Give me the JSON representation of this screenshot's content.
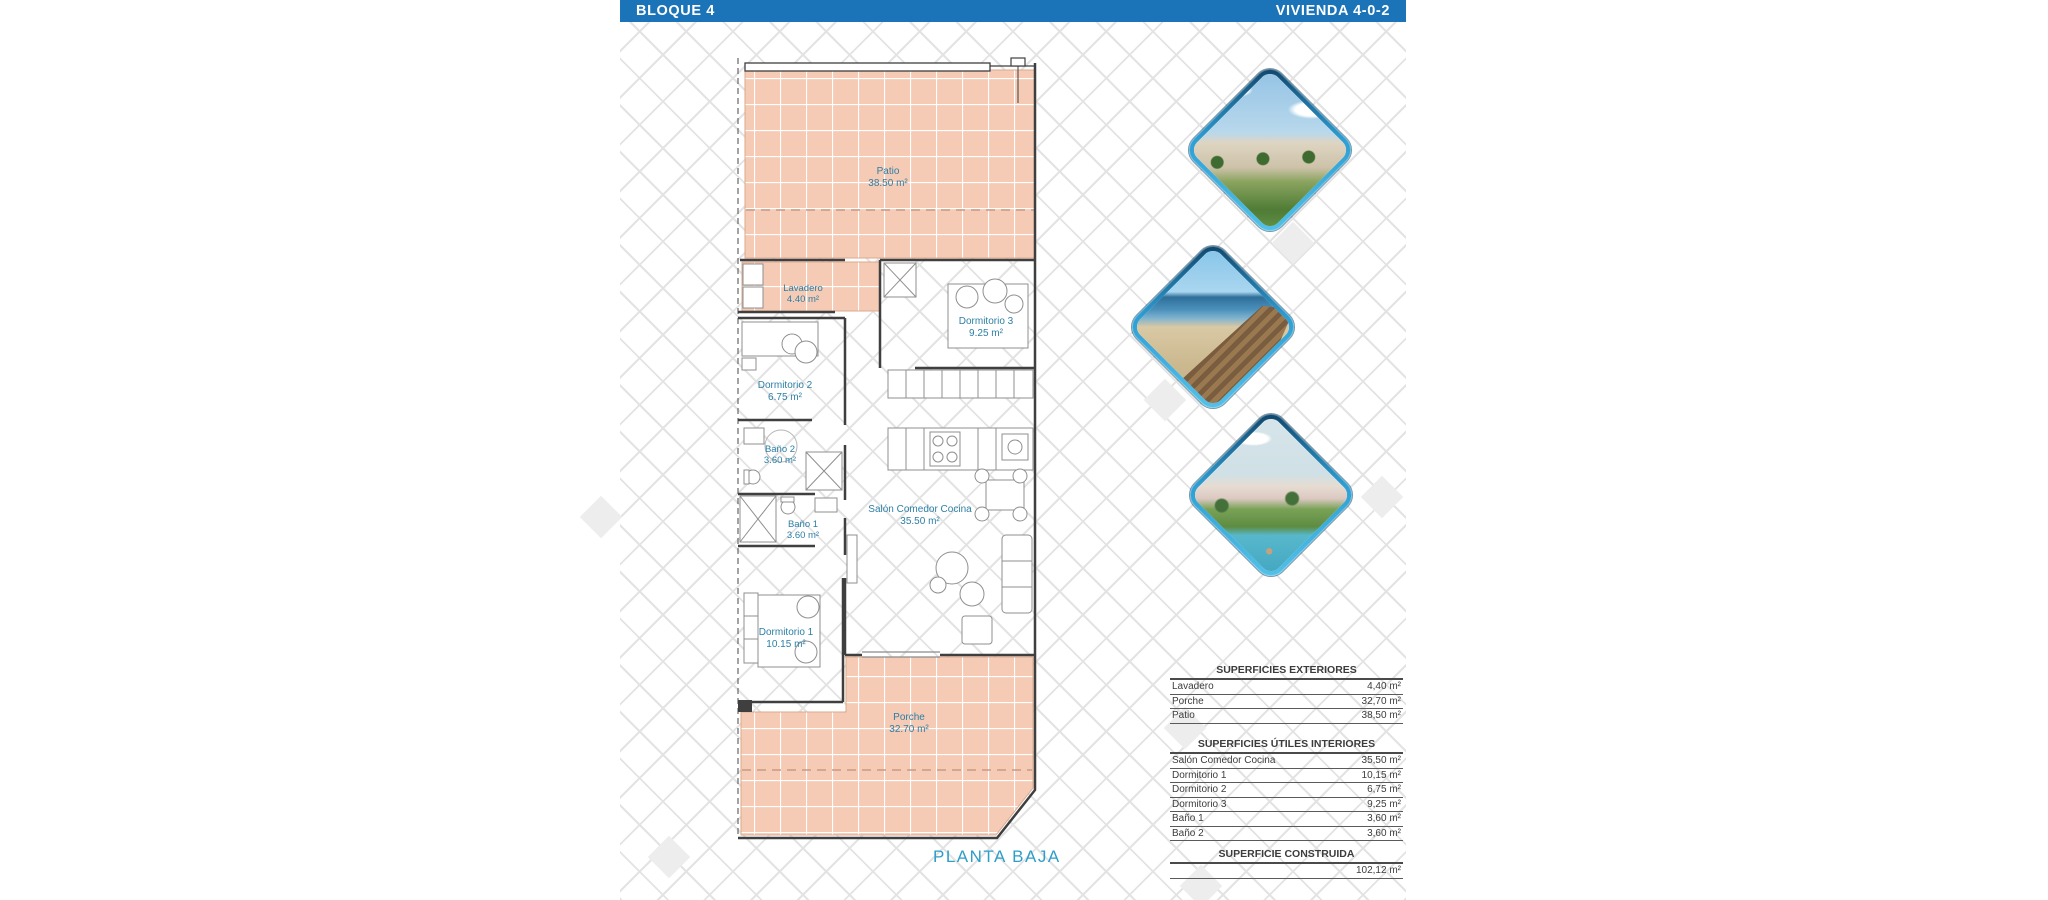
{
  "header": {
    "block_label": "BLOQUE 4",
    "unit_label": "VIVIENDA 4-0-2"
  },
  "plan": {
    "floor_label": "PLANTA BAJA",
    "compass_label": "N",
    "rooms": {
      "patio": {
        "name": "Patio",
        "area": "38.50 m²"
      },
      "lavadero": {
        "name": "Lavadero",
        "area": "4.40 m²"
      },
      "dormitorio3": {
        "name": "Dormitorio 3",
        "area": "9.25 m²"
      },
      "dormitorio2": {
        "name": "Dormitorio 2",
        "area": "6.75 m²"
      },
      "bano2": {
        "name": "Baño 2",
        "area": "3.60 m²"
      },
      "bano1": {
        "name": "Baño 1",
        "area": "3.60 m²"
      },
      "salon": {
        "name": "Salón Comedor Cocina",
        "area": "35.50 m²"
      },
      "dormitorio1": {
        "name": "Dormitorio 1",
        "area": "10.15 m²"
      },
      "porche": {
        "name": "Porche",
        "area": "32.70 m²"
      }
    }
  },
  "gallery": {
    "image1": "residential-complex-render",
    "image2": "beach-boardwalk-photo",
    "image3": "pool-resort-render"
  },
  "tables": {
    "exteriores": {
      "title": "SUPERFICIES EXTERIORES",
      "rows": [
        {
          "label": "Lavadero",
          "value": "4,40 m²"
        },
        {
          "label": "Porche",
          "value": "32,70 m²"
        },
        {
          "label": "Patio",
          "value": "38,50 m²"
        }
      ]
    },
    "interiores": {
      "title": "SUPERFICIES ÚTILES INTERIORES",
      "rows": [
        {
          "label": "Salón Comedor Cocina",
          "value": "35,50 m²"
        },
        {
          "label": "Dormitorio 1",
          "value": "10,15 m²"
        },
        {
          "label": "Dormitorio 2",
          "value": "6,75 m²"
        },
        {
          "label": "Dormitorio 3",
          "value": "9,25 m²"
        },
        {
          "label": "Baño 1",
          "value": "3,60 m²"
        },
        {
          "label": "Baño 2",
          "value": "3,60 m²"
        }
      ]
    },
    "construida": {
      "title": "SUPERFICIE CONSTRUIDA",
      "value": "102,12 m²"
    }
  },
  "colors": {
    "header_bar": "#1b74b8",
    "room_label": "#2c7fa6",
    "floor_label": "#2e9dc9",
    "tile_fill": "#f6cbb5"
  }
}
